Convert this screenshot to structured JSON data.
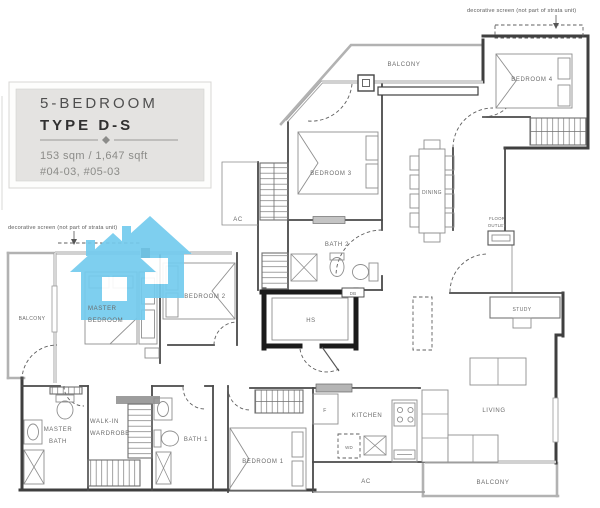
{
  "title_block": {
    "bedroom_count": "5-BEDROOM",
    "type_code": "TYPE D-S",
    "area": "153 sqm / 1,647 sqft",
    "units": "#04-03, #05-03"
  },
  "annotations": {
    "decorative_screen_top": "decorative screen (not part of strata unit)",
    "decorative_screen_left": "decorative screen (not part of strata unit)",
    "floor_outlet_line1": "FLOOR",
    "floor_outlet_line2": "OUTLET"
  },
  "rooms": {
    "balcony_top": "BALCONY",
    "bedroom4": "BEDROOM 4",
    "bedroom3": "BEDROOM 3",
    "dining": "DINING",
    "ac_side": "AC",
    "bath2": "BATH 2",
    "master_bedroom_line1": "MASTER",
    "master_bedroom_line2": "BEDROOM",
    "bedroom2": "BEDROOM 2",
    "balcony_left": "BALCONY",
    "hs": "HS",
    "study": "STUDY",
    "master_bath_line1": "MASTER",
    "master_bath_line2": "BATH",
    "walkin_line1": "WALK-IN",
    "walkin_line2": "WARDROBE",
    "bath1": "BATH 1",
    "bedroom1": "BEDROOM 1",
    "kitchen": "KITCHEN",
    "living": "LIVING",
    "ac_bottom": "AC",
    "balcony_bottom": "BALCONY"
  },
  "fixtures": {
    "fridge": "F",
    "washer_dryer": "WD",
    "db": "DB"
  },
  "colors": {
    "watermark_blue": "#74cbee",
    "wall_dark": "#3f3f3f",
    "titleblock_bg": "#e4e3e1"
  }
}
